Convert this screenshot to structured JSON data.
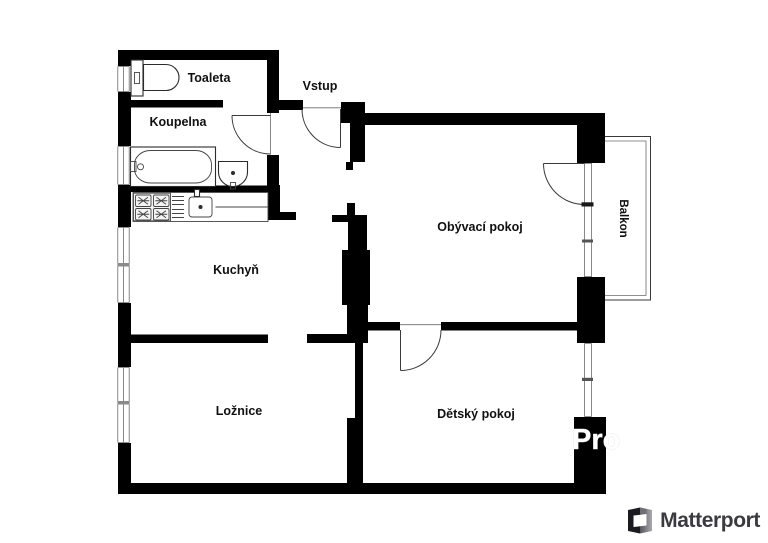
{
  "floorplan": {
    "rooms": {
      "toaleta": "Toaleta",
      "koupelna": "Koupelna",
      "vstup": "Vstup",
      "kuchyn": "Kuchyň",
      "obyvaci_pokoj": "Obývací pokoj",
      "loznice": "Ložnice",
      "detsky_pokoj": "Dětský pokoj",
      "balkon": "Balkon"
    },
    "watermark_text": "Pro",
    "icons": {
      "toilet-icon": "tank with rounded bowl outline",
      "bathtub-icon": "rounded tub outline with faucet",
      "washbasin-icon": "flat-top round basin with drain and tap",
      "stove-icon": "four-burner cooktop",
      "kitchen-sink-icon": "square basin with drain and tap",
      "door-swing-icon": "quarter-circle door arc",
      "window-icon": "double glazing lines in wall gap",
      "balcony-icon": "double outline railing"
    },
    "colors": {
      "wall": "#000000",
      "line": "#3a3a3a",
      "background": "#ffffff",
      "watermark": "#ffffff",
      "window_tick": "#8a8a8a"
    }
  },
  "branding": {
    "logo_text": "Matterport",
    "text_color": "#3a3a40",
    "icon_colors": {
      "dark": "#1b1b20",
      "mid": "#6e6e76",
      "light": "#a9a9af"
    }
  }
}
